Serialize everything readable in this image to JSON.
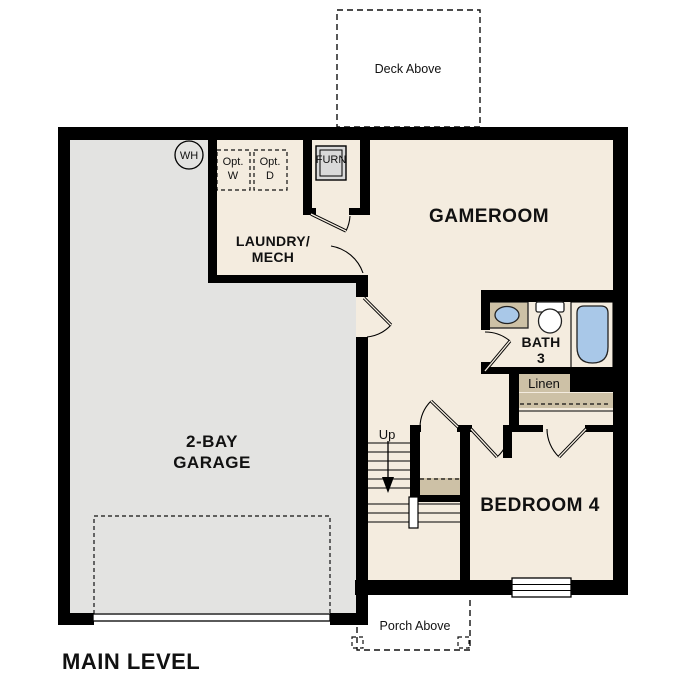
{
  "plan": {
    "title": "MAIN LEVEL",
    "rooms": {
      "gameroom": "GAMEROOM",
      "laundry_line1": "LAUNDRY/",
      "laundry_line2": "MECH",
      "garage_line1": "2-BAY",
      "garage_line2": "GARAGE",
      "bath_line1": "BATH",
      "bath_line2": "3",
      "bedroom": "BEDROOM 4",
      "linen": "Linen"
    },
    "annotations": {
      "deck": "Deck Above",
      "porch": "Porch Above",
      "water_heater": "WH",
      "furnace": "FURN",
      "opt_prefix": "Opt.",
      "washer": "W",
      "dryer": "D",
      "stairs_direction": "Up"
    },
    "colors": {
      "wall": "#000000",
      "floor_cream": "#f4ecdf",
      "garage_gray": "#e3e3e1",
      "cabinet_tan": "#cdc1a6",
      "fixture_blue": "#a9c8e8",
      "appliance_gray": "#d9d9d9",
      "fixture_white": "#ffffff"
    }
  }
}
